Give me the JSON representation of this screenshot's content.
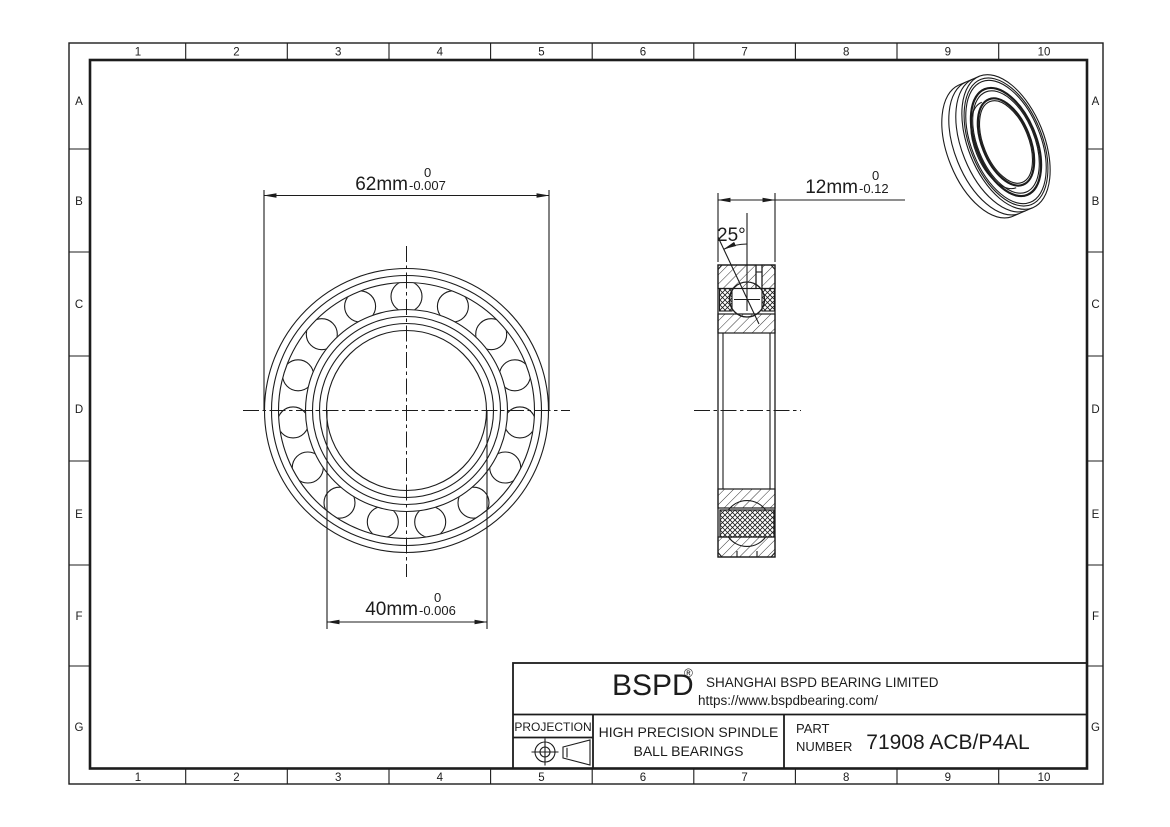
{
  "drawing": {
    "grid": {
      "cols": [
        "1",
        "2",
        "3",
        "4",
        "5",
        "6",
        "7",
        "8",
        "9",
        "10"
      ],
      "rows": [
        "A",
        "B",
        "C",
        "D",
        "E",
        "F",
        "G"
      ]
    },
    "dims": {
      "outer_diameter": {
        "value": "62mm",
        "tol_upper": "0",
        "tol_lower": "-0.007"
      },
      "bore_diameter": {
        "value": "40mm",
        "tol_upper": "0",
        "tol_lower": "-0.006"
      },
      "width": {
        "value": "12mm",
        "tol_upper": "0",
        "tol_lower": "-0.12"
      },
      "contact_angle": "25°"
    },
    "title_block": {
      "brand": "BSPD",
      "registered": "®",
      "company": "SHANGHAI BSPD BEARING LIMITED",
      "website": "https://www.bspdbearing.com/",
      "projection_label": "PROJECTION",
      "product_line1": "HIGH  PRECISION SPINDLE",
      "product_line2": "BALL BEARINGS",
      "part_label_line1": "PART",
      "part_label_line2": "NUMBER",
      "part_number": "71908 ACB/P4AL"
    },
    "colors": {
      "line": "#1c1c1c",
      "background": "#ffffff"
    }
  }
}
